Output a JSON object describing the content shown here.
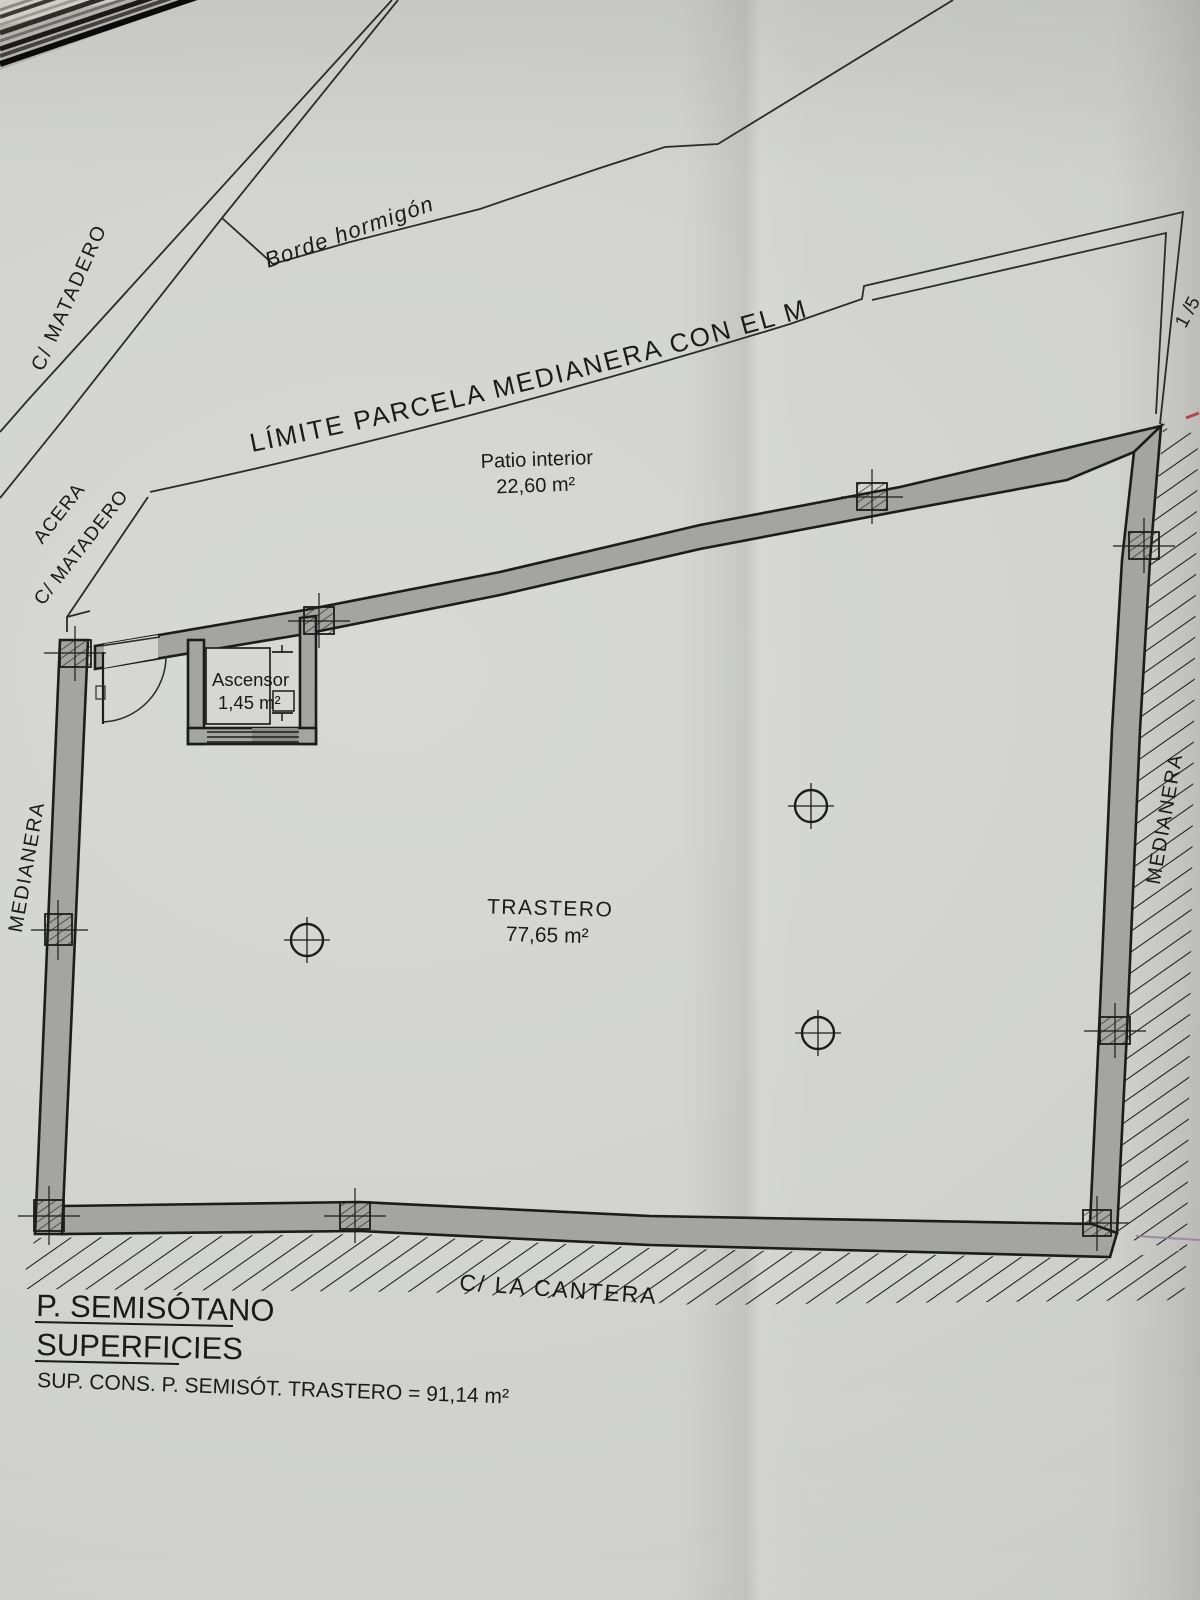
{
  "plan": {
    "streets": {
      "matadero_top": "C/ MATADERO",
      "acera": "ACERA",
      "matadero_side": "C/ MATADERO",
      "cantera": "C/ LA CANTERA"
    },
    "boundaries": {
      "borde_hormigon": "Borde hormigón",
      "limite": "LÍMITE PARCELA MEDIANERA CON EL MATADERO",
      "medianera_left": "MEDIANERA",
      "medianera_right": "MEDIANERA"
    },
    "rooms": {
      "patio": {
        "name": "Patio interior",
        "area": "22,60 m²"
      },
      "ascensor": {
        "name": "Ascensor",
        "area": "1,45 m²"
      },
      "trastero": {
        "name": "TRASTERO",
        "area": "77,65 m²"
      }
    },
    "edge_note": "1 /5"
  },
  "footer": {
    "title": "P. SEMISÓTANO",
    "subtitle": "SUPERFICIES",
    "surface_line": "SUP. CONS. P. SEMISÓT. TRASTERO =  91,14 m²"
  },
  "colors": {
    "paper": "#d2d3cf",
    "ink": "#1c1c1c",
    "wall_fill": "#a4a5a1",
    "pencil_mark": "#8f8292",
    "red_mark": "#b04848"
  }
}
